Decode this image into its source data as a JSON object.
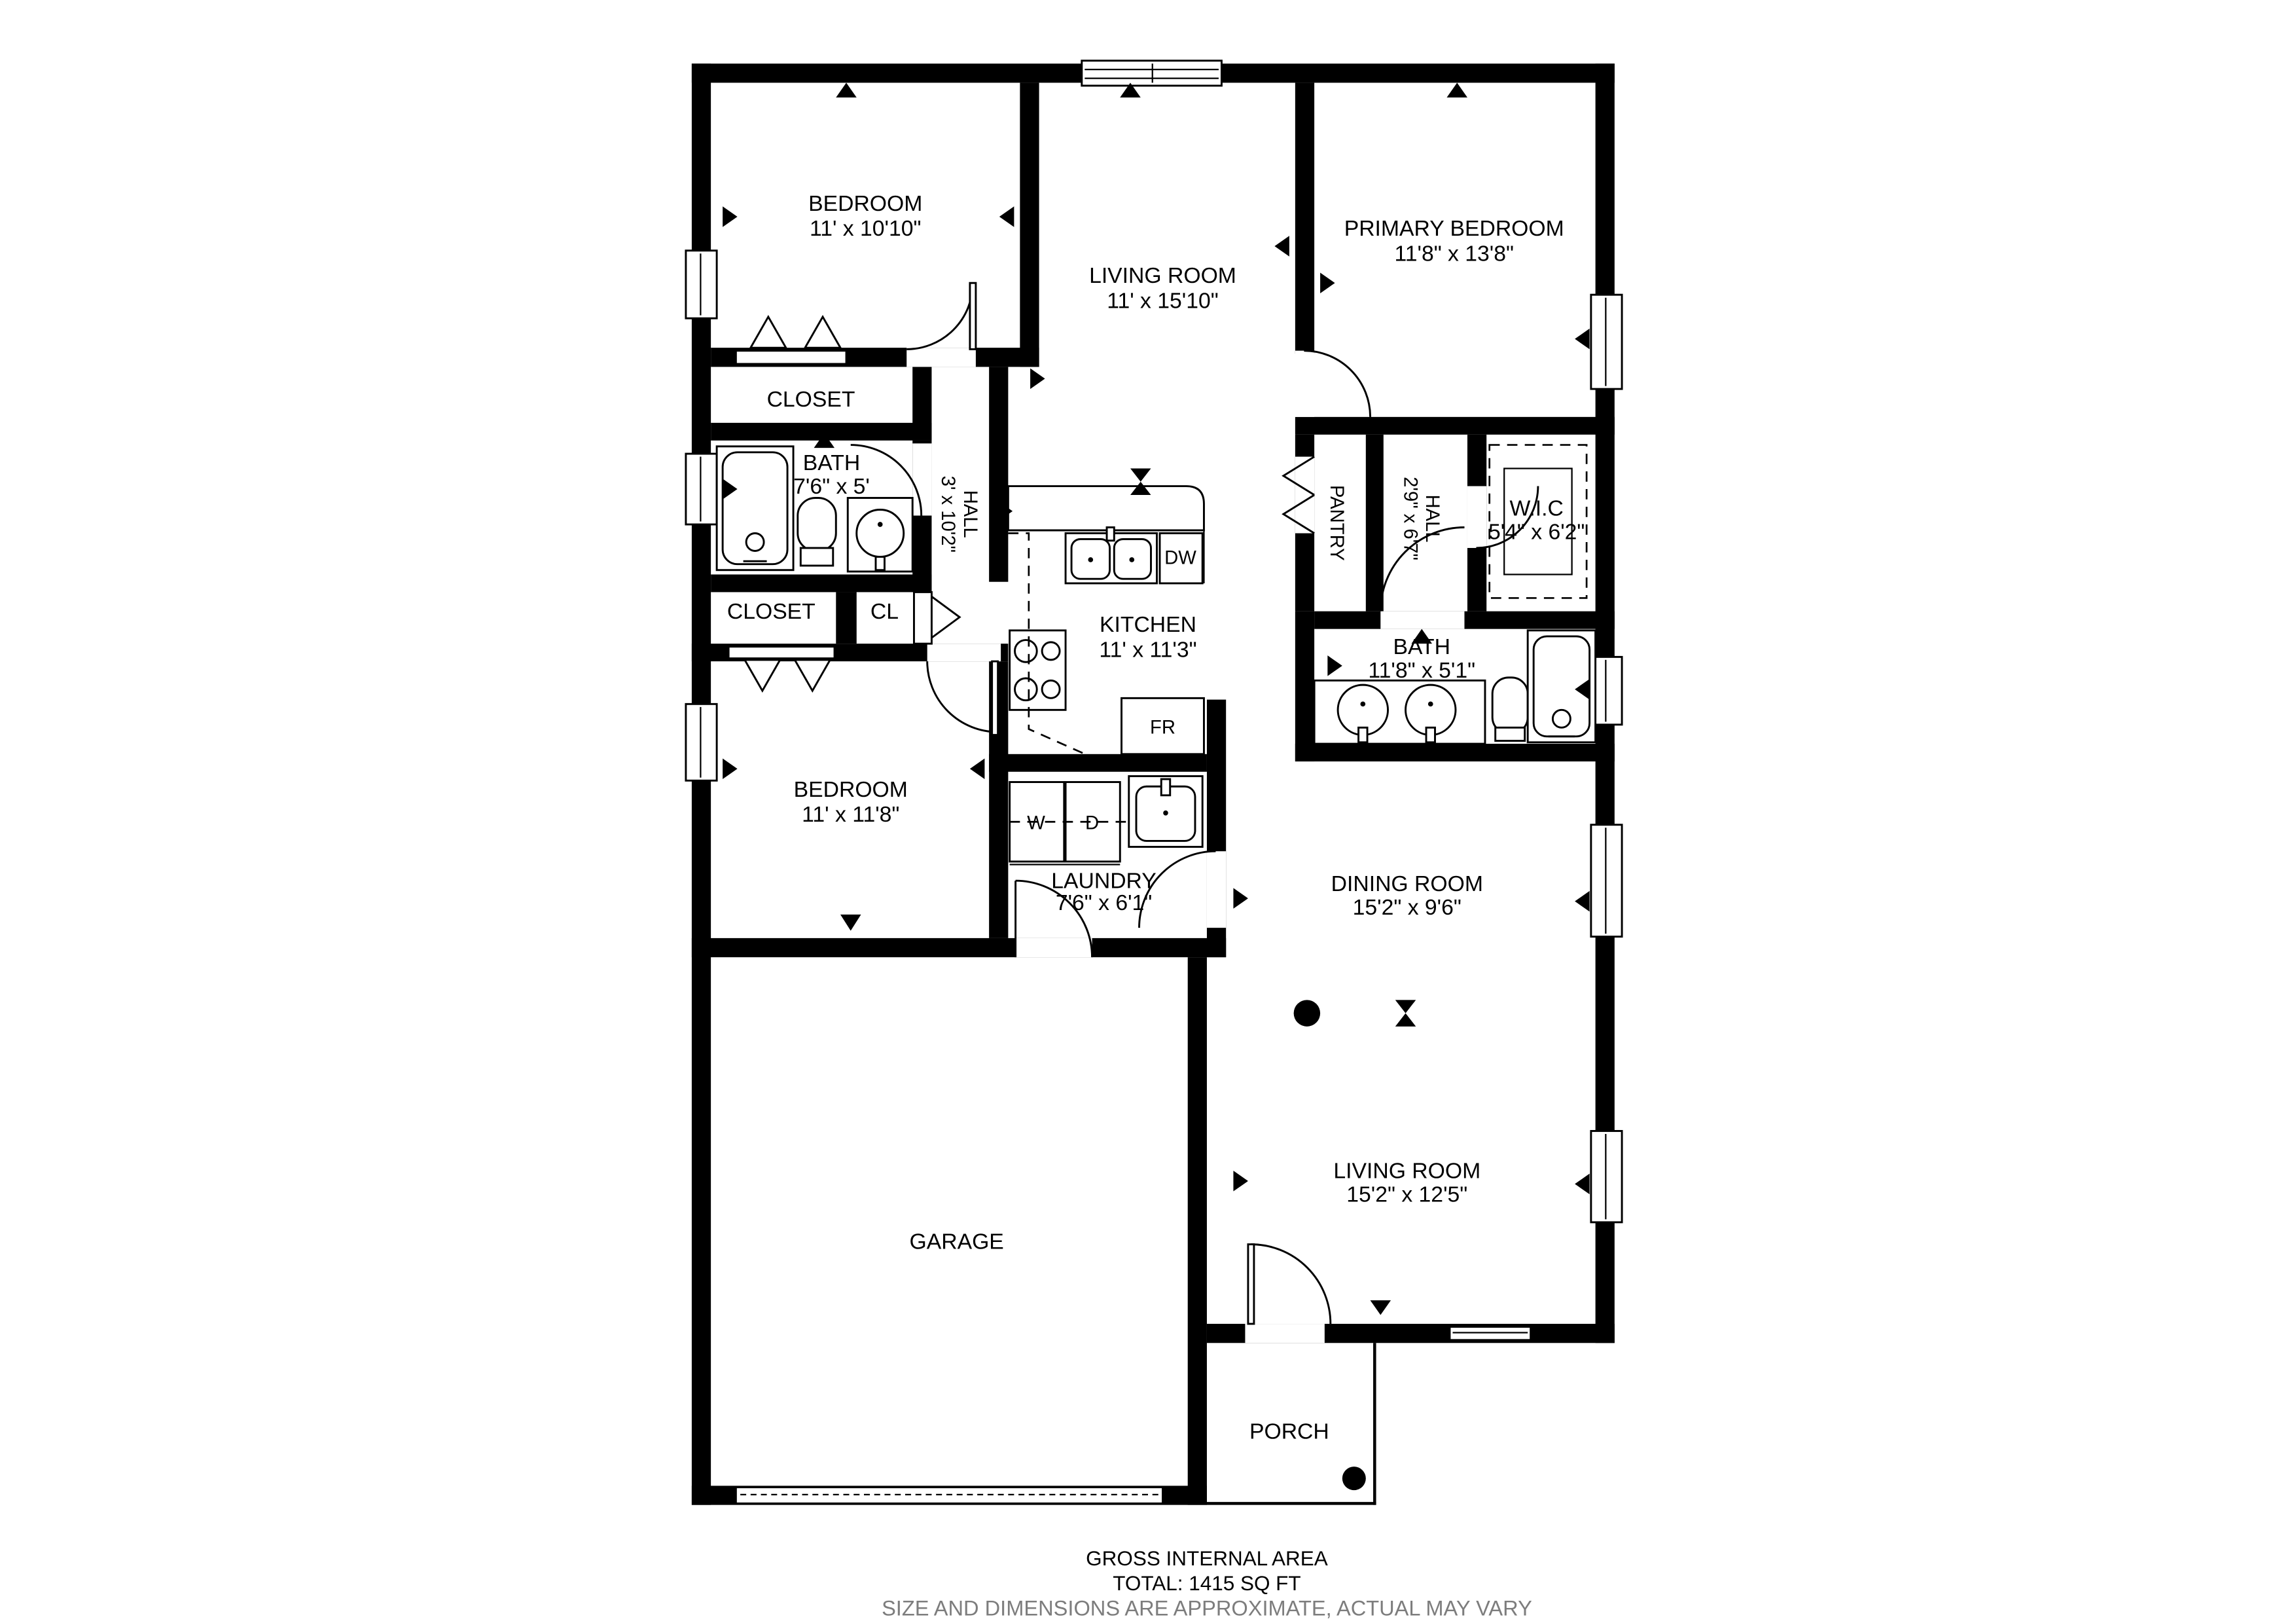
{
  "colors": {
    "wall": "#000000",
    "background": "#ffffff",
    "caption_muted": "#7d7d7d"
  },
  "rooms": {
    "bedroom1": {
      "name": "BEDROOM",
      "dims": "11' x 10'10\""
    },
    "living1": {
      "name": "LIVING ROOM",
      "dims": "11' x 15'10\""
    },
    "primary": {
      "name": "PRIMARY BEDROOM",
      "dims": "11'8\" x 13'8\""
    },
    "closet1": {
      "name": "CLOSET"
    },
    "bath1": {
      "name": "BATH",
      "dims": "7'6\" x 5'"
    },
    "hall1": {
      "name": "HALL",
      "dims": "3' x 10'2\""
    },
    "closet2": {
      "name": "CLOSET"
    },
    "cl": {
      "name": "CL"
    },
    "kitchen": {
      "name": "KITCHEN",
      "dims": "11' x 11'3\""
    },
    "pantry": {
      "name": "PANTRY"
    },
    "hall2": {
      "name": "HALL",
      "dims": "2'9\" x 6'7\""
    },
    "wic": {
      "name": "W.I.C",
      "dims": "5'4\" x 6'2\""
    },
    "bath2": {
      "name": "BATH",
      "dims": "11'8\" x 5'1\""
    },
    "bedroom2": {
      "name": "BEDROOM",
      "dims": "11' x 11'8\""
    },
    "laundry": {
      "name": "LAUNDRY",
      "dims": "7'6\" x 6'1\""
    },
    "dining": {
      "name": "DINING ROOM",
      "dims": "15'2\" x 9'6\""
    },
    "living2": {
      "name": "LIVING ROOM",
      "dims": "15'2\" x 12'5\""
    },
    "garage": {
      "name": "GARAGE"
    },
    "porch": {
      "name": "PORCH"
    }
  },
  "appliances": {
    "washer": "W",
    "dryer": "D",
    "fridge": "FR",
    "dishwasher": "DW"
  },
  "footer": {
    "line1": "GROSS INTERNAL AREA",
    "line2": "TOTAL: 1415 SQ FT",
    "line3": "SIZE AND DIMENSIONS ARE APPROXIMATE, ACTUAL MAY VARY"
  }
}
